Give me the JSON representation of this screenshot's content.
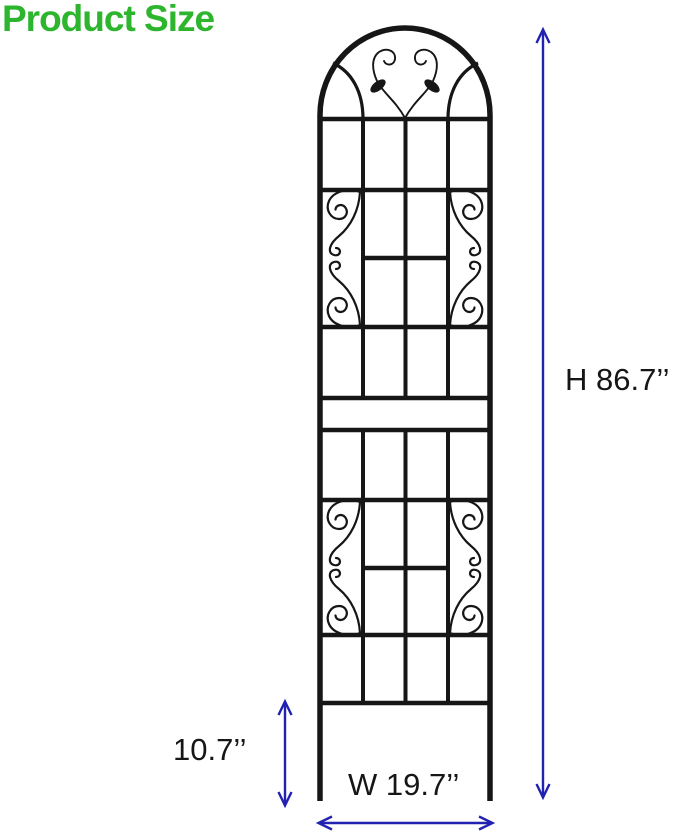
{
  "title": {
    "text": "Product Size"
  },
  "colors": {
    "title_green": "#2eb52e",
    "dimension_blue": "#2121b2",
    "trellis_black": "#161616"
  },
  "dimensions": {
    "height": {
      "label": "H 86.7’’",
      "arrow": "vertical-double-arrow"
    },
    "stake": {
      "label": "10.7’’",
      "arrow": "vertical-double-arrow"
    },
    "width": {
      "label": "W 19.7’’",
      "arrow": "horizontal-double-arrow"
    }
  },
  "illustration": {
    "subject": "arched metal garden trellis with scroll flourishes and leaf ornaments"
  }
}
